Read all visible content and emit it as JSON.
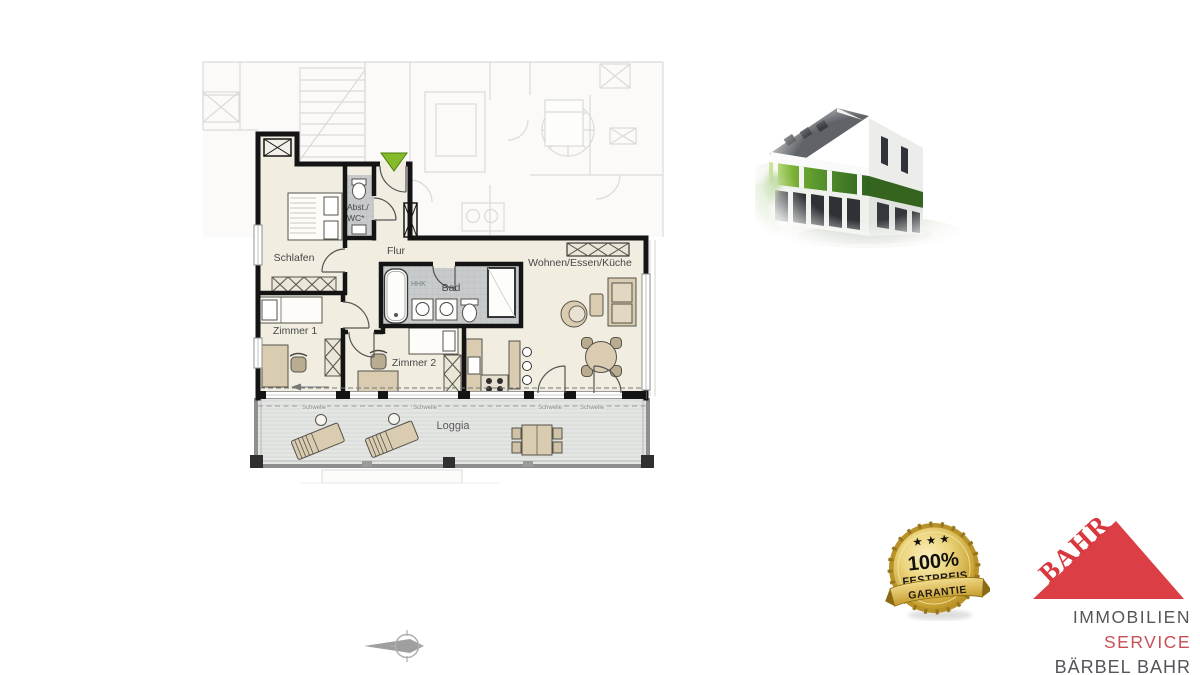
{
  "floorplan": {
    "labels": {
      "schlafen": "Schlafen",
      "abstwc_line1": "Abst./",
      "abstwc_line2": "WC*",
      "flur": "Flur",
      "wohnen": "Wohnen/Essen/Küche",
      "zimmer1": "Zimmer 1",
      "bad": "Bad",
      "hhk": "HHK",
      "zimmer2": "Zimmer 2",
      "loggia": "Loggia"
    },
    "thresholds": [
      "Schwelle",
      "Schwelle",
      "Schwelle",
      "Schwelle"
    ],
    "colors": {
      "wall": "#141414",
      "floor": "#f1eee1",
      "bath_tile": "#c7cbcb",
      "furniture": "#d9ccb1",
      "loggia_floor": "#e4e6e4",
      "entrance_green": "#85bb28"
    }
  },
  "badge": {
    "stars": "★ ★ ★",
    "percent": "100%",
    "line2": "FESTPREIS",
    "line3": "GARANTIE",
    "colors": {
      "gold": "#d4ab37",
      "text": "#1c1a17"
    }
  },
  "logo": {
    "brand": "BAHR",
    "line1": "IMMOBILIEN",
    "line2": "SERVICE",
    "line3": "BÄRBEL BAHR",
    "colors": {
      "red": "#dc3e45",
      "gray": "#57575a"
    }
  }
}
